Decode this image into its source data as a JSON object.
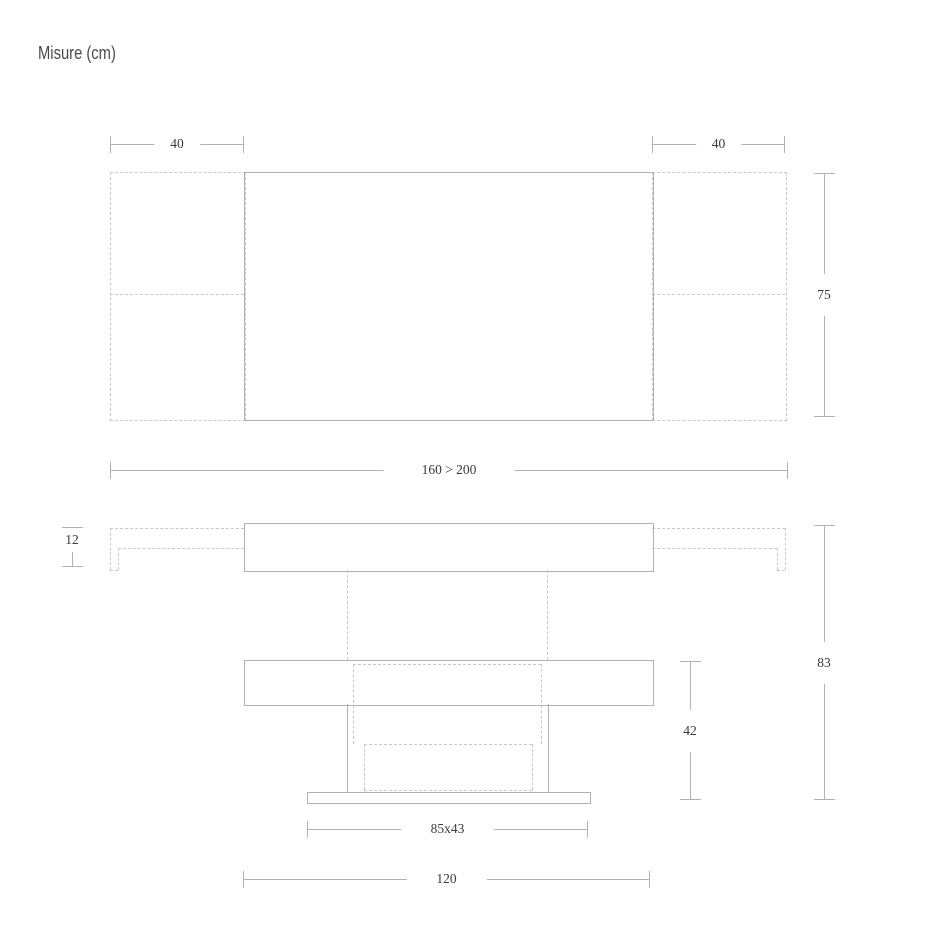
{
  "title": "Misure (cm)",
  "top_view": {
    "left_leaf_width": "40",
    "right_leaf_width": "40",
    "depth": "75",
    "length_closed_extended": "160 > 200"
  },
  "side_view": {
    "top_thickness": "12",
    "total_height": "83",
    "lowered_height": "42",
    "base_footprint": "85x43",
    "closed_width": "120"
  }
}
